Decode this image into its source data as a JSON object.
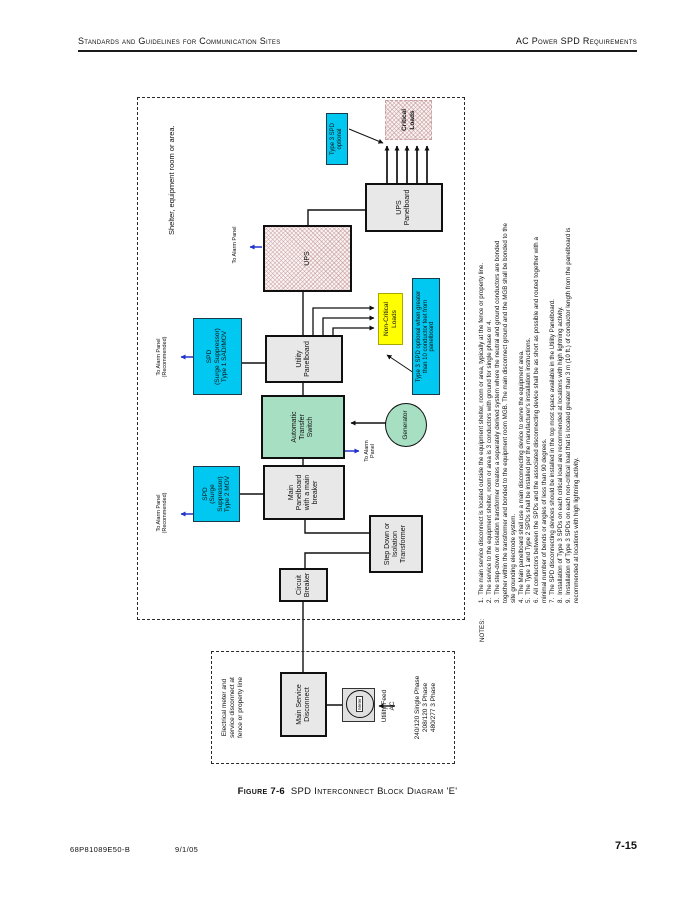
{
  "header": {
    "left": "Standards and Guidelines for Communication Sites",
    "right": "AC Power SPD Requirements"
  },
  "footer": {
    "doc_number": "68P81089E50-B",
    "date": "9/1/05",
    "page_number": "7-15"
  },
  "caption": {
    "label": "Figure 7-6",
    "title": "SPD Interconnect Block Diagram 'E'"
  },
  "diagram": {
    "shelter_label": "Shelter, equipment room or area.",
    "fence_label": "Electrical meter and\nservice disconnect at\nfence or property line",
    "phase_options": "240/120 Single Phase\n208/120  3 Phase\n480/277  3 Phase",
    "boxes": {
      "main_service_disconnect": "Main Service\nDisconnect",
      "meter": "Meter",
      "utility_feed": "Utility Feed\nAC",
      "circuit_breaker": "Circuit\nBreaker",
      "transformer": "Step Down or\nIsolation\nTransformer",
      "main_panelboard": "Main\nPanelboard\nwith a main\nbreaker",
      "spd_type2": "SPD\n(Surge\nSuppressor)\nType 2 MOV",
      "ats": "Automatic\nTransfer\nSwitch",
      "generator": "Generator",
      "utility_panelboard": "Utility\nPanelboard",
      "spd_type1": "SPD\n(Surge Suppressor)\nType 1 SAD/MOV",
      "non_critical_loads": "Non-Critical\nLoads",
      "type3_when_greater": "Type 3 SPD optional when greater\nthan 10 conductor feet from\npanelboard",
      "ups": "UPS",
      "ups_panelboard": "UPS\nPanelboard",
      "critical_loads": "Critical\nLoads",
      "type3_optional": "Type 3 SPD\noptional"
    },
    "labels": {
      "alarm_recommended": "To Alarm Panel\n(Recommended)",
      "alarm_two_line": "To Alarm\nPanel",
      "alarm_one_line": "To Alarm Panel"
    },
    "notes_label": "NOTES:",
    "notes": [
      {
        "n": "1.",
        "t": "The main service disconnect is located outside the equipment shelter, room or area, typically at the fence or property line."
      },
      {
        "n": "2.",
        "t": "The service to the equipment shelter, room or area is 3 conductors with ground for single phase or 4."
      },
      {
        "n": "3.",
        "t": "The step-down or isolation transformer creates a separately derived system where the neutral and ground conductors are bonded together within the transformer and bonded to the equipment room MGB.  The main disconnect ground and the MGB shall be bonded to the site grounding electrode system."
      },
      {
        "n": "4.",
        "t": "The Main panelboard shall use a main disconnecting device to serve the equipment area."
      },
      {
        "n": "5.",
        "t": "The Type 1 and Type 2 SPDs shall be installed per the manufacturer's installation instructions."
      },
      {
        "n": "6.",
        "t": "All conductors between the SPDs and the associated disconnecting device shall be as short as possible and routed together with a minimal number of bends or angles of less than 90 degrees."
      },
      {
        "n": "7.",
        "t": "The SPD disconnecting devices should be installed in the top most space available in the Utility Panelboard."
      },
      {
        "n": "8.",
        "t": "Installation of Type 3 SPDs on each critical load are recommended at locations with high lightning activity."
      },
      {
        "n": "9.",
        "t": "Installation of Type 3 SPDs on each non-critical load that is located greater than 3 m (10 ft.) of conductor length from the panelboard is recommended at locations with high lightning activity."
      }
    ],
    "colors": {
      "cyan": "#00C8F0",
      "yellow": "#FFFF00",
      "green": "#A6DFC2",
      "box_gray": "#E8E8E8",
      "blue_arrow": "#2233CC"
    }
  }
}
